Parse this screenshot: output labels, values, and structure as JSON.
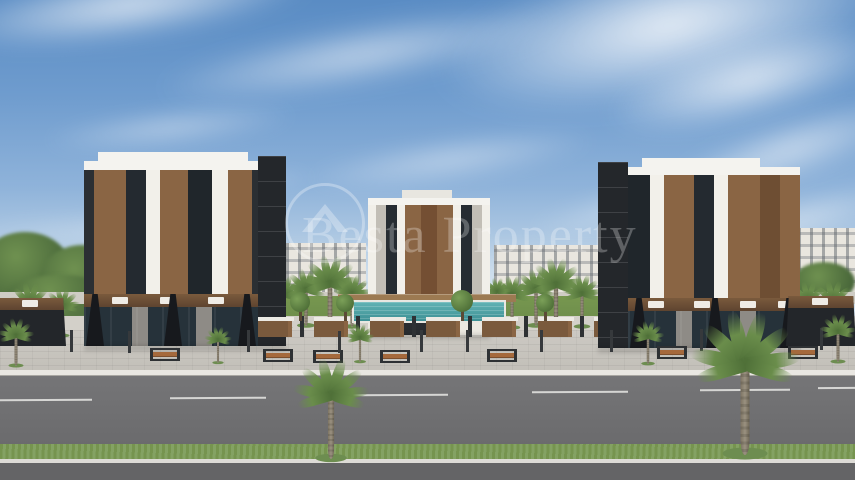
{
  "meta": {
    "type": "3d-architectural-rendering",
    "subject": "Residential complex street view with three apartment blocks, pool courtyard, palm trees and road",
    "width_px": 855,
    "height_px": 480
  },
  "watermark": {
    "text": "Besta Property",
    "logo": "house-in-circle-icon"
  },
  "palette": {
    "sky_top": "#5a8cc4",
    "sky_horizon": "#dfe9f1",
    "cloud": "#ffffff",
    "building_white": "#f2f0ea",
    "building_charcoal": "#24272b",
    "building_wood": "#8a6544",
    "window_glass": "#232b31",
    "background_building": "#e9e6df",
    "storefront_sign_wood": "#7a5a3d",
    "pavement": "#c9c6c0",
    "curb": "#e9e7e2",
    "road_asphalt": "#6f6f71",
    "lane_marking": "#d6d6d4",
    "grass_median": "#7d9b5d",
    "pool_water": "#43989c",
    "palm_leaf": "#6a8d4b",
    "palm_trunk": "#8d846f",
    "bench_wood": "#a5693c"
  },
  "scene": {
    "buildings": [
      {
        "name": "left-block",
        "residential_floors": 5,
        "ground_use": "retail-storefronts"
      },
      {
        "name": "center-block",
        "residential_floors": 6,
        "ground_use": "lobby"
      },
      {
        "name": "right-block",
        "residential_floors": 5,
        "ground_use": "retail-storefronts"
      }
    ],
    "lane_dashes": [
      {
        "x": 0,
        "y": 399,
        "w": 92
      },
      {
        "x": 170,
        "y": 397,
        "w": 96
      },
      {
        "x": 352,
        "y": 394,
        "w": 96
      },
      {
        "x": 532,
        "y": 391,
        "w": 96
      },
      {
        "x": 700,
        "y": 389,
        "w": 90
      },
      {
        "x": 818,
        "y": 387,
        "w": 37
      }
    ],
    "benches": [
      {
        "x": 150,
        "y": 348
      },
      {
        "x": 263,
        "y": 349
      },
      {
        "x": 313,
        "y": 350
      },
      {
        "x": 380,
        "y": 350
      },
      {
        "x": 487,
        "y": 349
      },
      {
        "x": 657,
        "y": 346
      },
      {
        "x": 788,
        "y": 346
      }
    ],
    "lamps": [
      {
        "x": 70,
        "y": 330
      },
      {
        "x": 128,
        "y": 331
      },
      {
        "x": 247,
        "y": 330
      },
      {
        "x": 338,
        "y": 331
      },
      {
        "x": 420,
        "y": 330
      },
      {
        "x": 466,
        "y": 330
      },
      {
        "x": 540,
        "y": 330
      },
      {
        "x": 610,
        "y": 330
      },
      {
        "x": 700,
        "y": 329
      },
      {
        "x": 820,
        "y": 328
      }
    ],
    "planter_trees": [
      {
        "x": 300,
        "y": 320,
        "r": 10
      },
      {
        "x": 345,
        "y": 320,
        "r": 9
      },
      {
        "x": 462,
        "y": 320,
        "r": 11
      },
      {
        "x": 545,
        "y": 320,
        "r": 9
      }
    ],
    "palms": [
      {
        "x": 331,
        "y": 459,
        "s": 1.05,
        "l": "front"
      },
      {
        "x": 745,
        "y": 455,
        "s": 1.5,
        "l": "front"
      },
      {
        "x": 16,
        "y": 366,
        "s": 0.5,
        "l": "front"
      },
      {
        "x": 218,
        "y": 363,
        "s": 0.38,
        "l": "front"
      },
      {
        "x": 360,
        "y": 362,
        "s": 0.4,
        "l": "front"
      },
      {
        "x": 648,
        "y": 364,
        "s": 0.45,
        "l": "front"
      },
      {
        "x": 838,
        "y": 362,
        "s": 0.5,
        "l": "front"
      },
      {
        "x": 284,
        "y": 328,
        "s": 0.55,
        "l": "mid"
      },
      {
        "x": 306,
        "y": 326,
        "s": 0.6,
        "l": "mid"
      },
      {
        "x": 330,
        "y": 332,
        "s": 0.8,
        "l": "mid"
      },
      {
        "x": 352,
        "y": 327,
        "s": 0.55,
        "l": "mid"
      },
      {
        "x": 512,
        "y": 328,
        "s": 0.55,
        "l": "mid"
      },
      {
        "x": 536,
        "y": 326,
        "s": 0.6,
        "l": "mid"
      },
      {
        "x": 556,
        "y": 330,
        "s": 0.75,
        "l": "mid"
      },
      {
        "x": 582,
        "y": 327,
        "s": 0.55,
        "l": "mid"
      },
      {
        "x": 388,
        "y": 316,
        "s": 0.4,
        "l": "mid"
      },
      {
        "x": 497,
        "y": 316,
        "s": 0.4,
        "l": "mid"
      },
      {
        "x": 30,
        "y": 340,
        "s": 0.6,
        "l": "mid"
      },
      {
        "x": 62,
        "y": 336,
        "s": 0.5,
        "l": "mid"
      },
      {
        "x": 808,
        "y": 334,
        "s": 0.55,
        "l": "mid"
      },
      {
        "x": 833,
        "y": 338,
        "s": 0.6,
        "l": "mid"
      }
    ]
  }
}
